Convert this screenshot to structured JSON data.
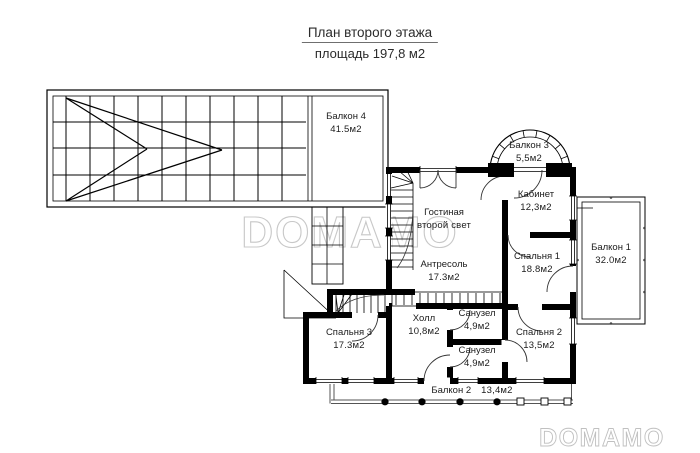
{
  "title": {
    "line1": "План второго этажа",
    "line2": "площадь 197,8 м2"
  },
  "watermark": {
    "text": "DOMAMO",
    "color": "#c8c8c8"
  },
  "colors": {
    "ink": "#000000",
    "background": "#ffffff",
    "label_text": "#1c1c1c"
  },
  "plan": {
    "floor": "второй этаж",
    "total_area": "197,8 м2",
    "rooms": [
      {
        "id": "balkon4",
        "name": "Балкон 4",
        "area": "41.5м2"
      },
      {
        "id": "balkon3",
        "name": "Балкон 3",
        "area": "5,5м2"
      },
      {
        "id": "kabinet",
        "name": "Кабинет",
        "area": "12,3м2"
      },
      {
        "id": "gostinaya",
        "name": "Гостиная",
        "area": "второй свет"
      },
      {
        "id": "antresol",
        "name": "Антресоль",
        "area": "17.3м2"
      },
      {
        "id": "spalnya1",
        "name": "Спальня 1",
        "area": "18.8м2"
      },
      {
        "id": "balkon1",
        "name": "Балкон 1",
        "area": "32.0м2"
      },
      {
        "id": "holl",
        "name": "Холл",
        "area": "10,8м2"
      },
      {
        "id": "sanuzel1",
        "name": "Санузел",
        "area": "4,9м2"
      },
      {
        "id": "sanuzel2",
        "name": "Санузел",
        "area": "4,9м2"
      },
      {
        "id": "spalnya2",
        "name": "Спальня 2",
        "area": "13,5м2"
      },
      {
        "id": "spalnya3",
        "name": "Спальня 3",
        "area": "17.3м2"
      },
      {
        "id": "balkon2",
        "name": "Балкон 2",
        "area": "13,4м2"
      }
    ]
  }
}
